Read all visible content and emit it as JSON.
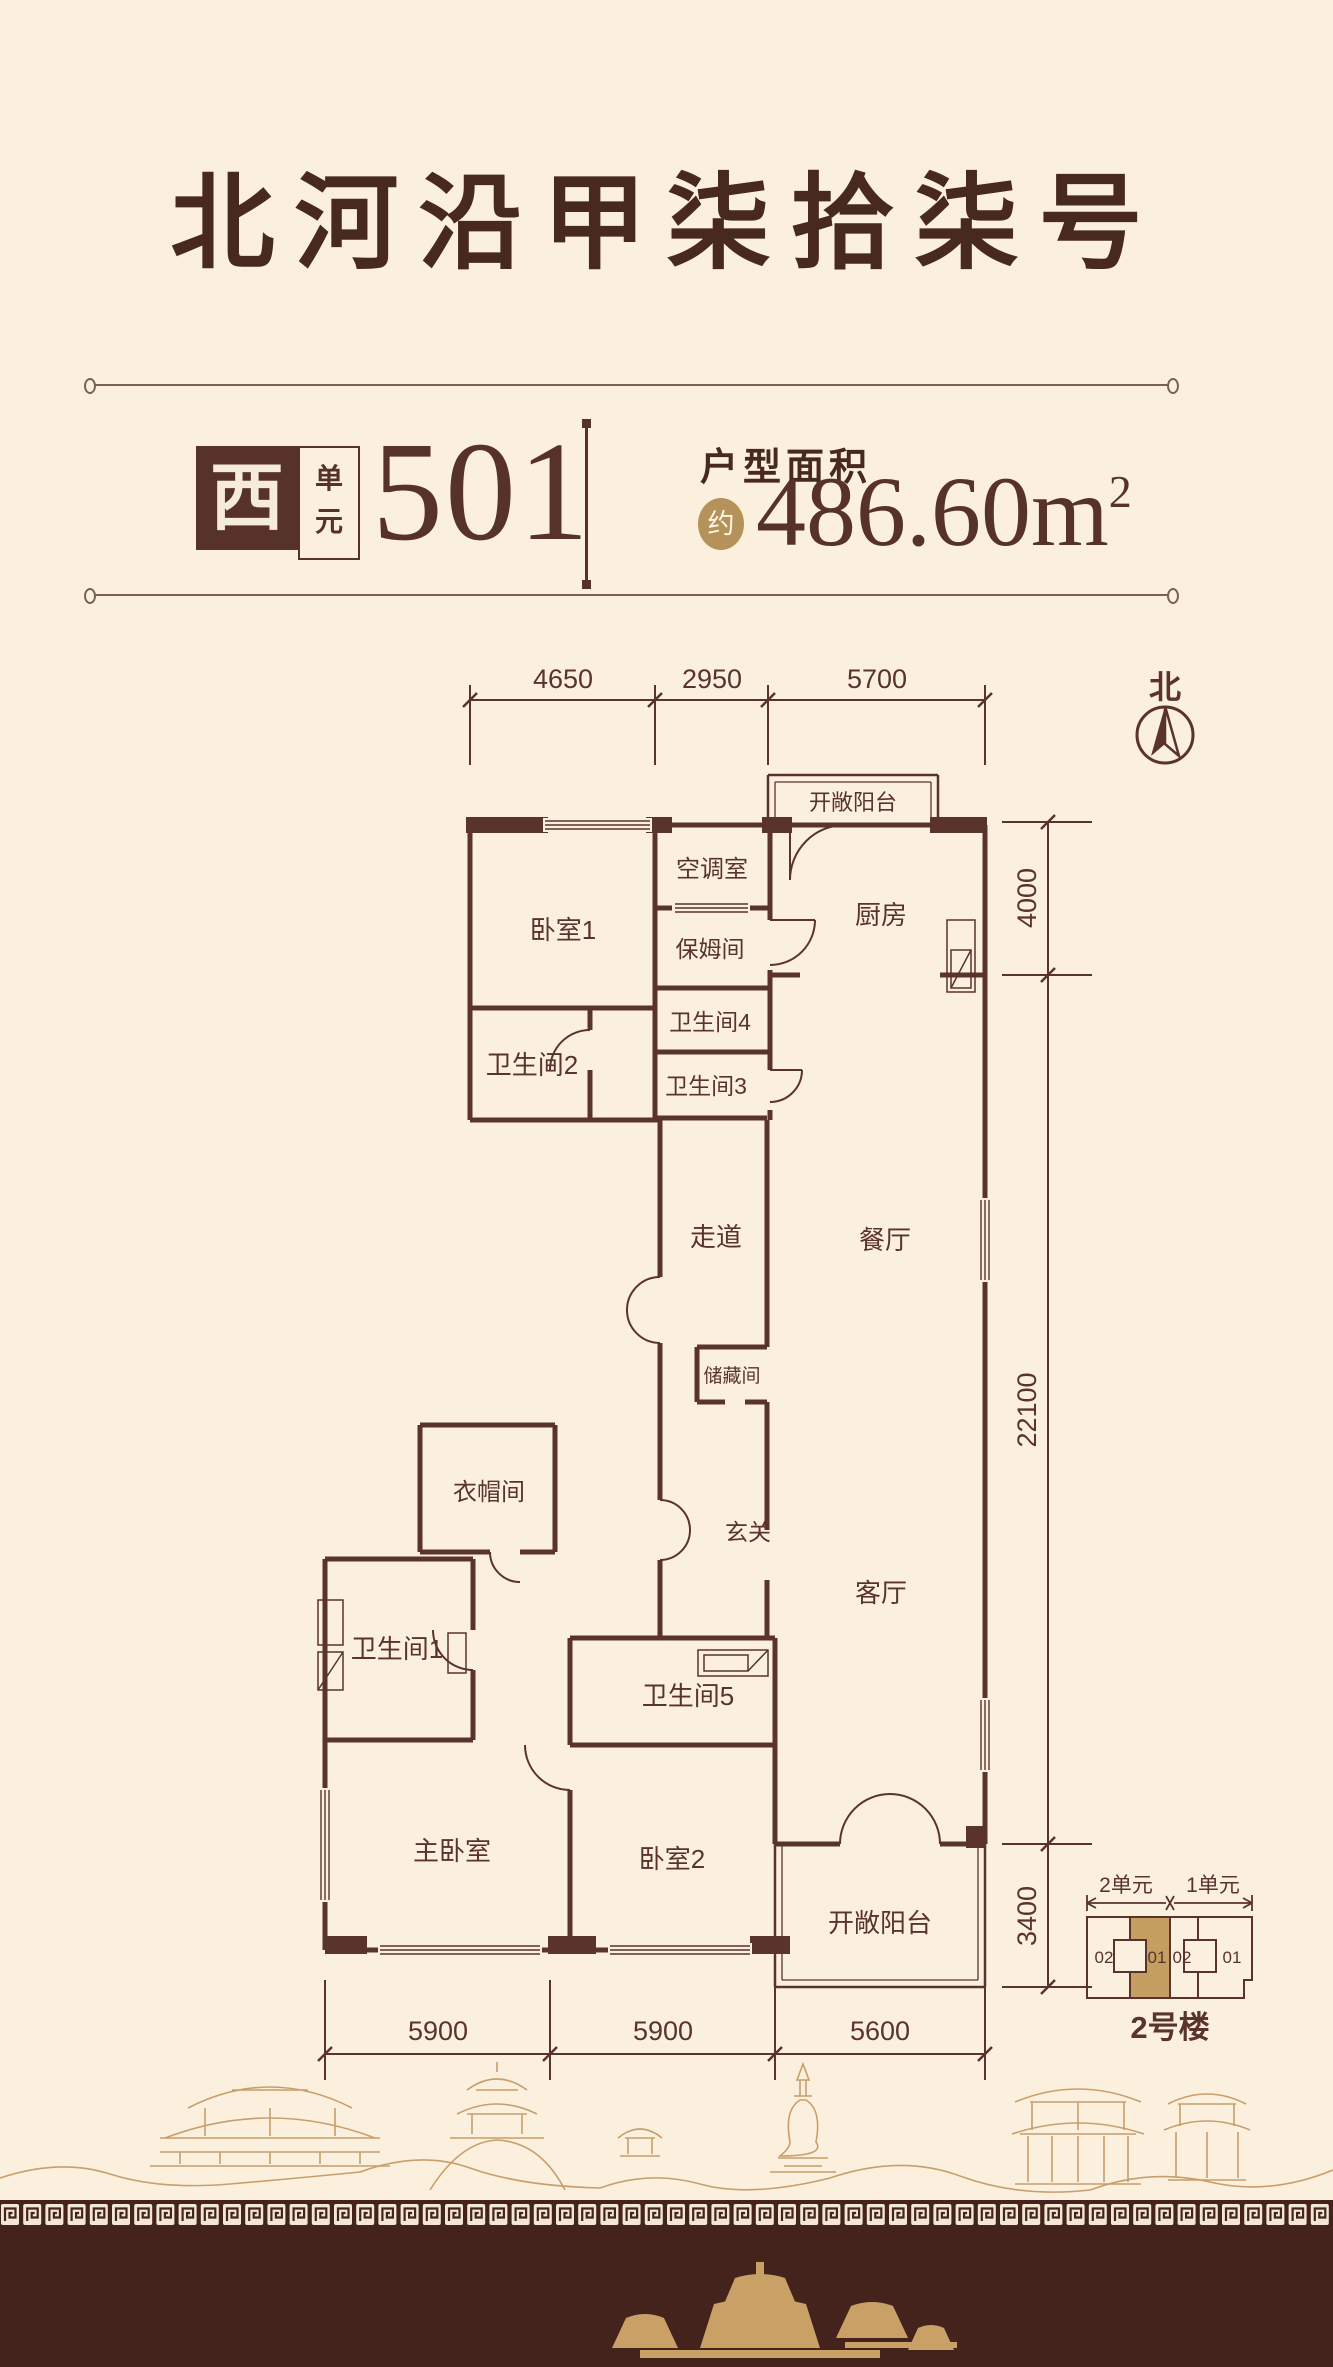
{
  "header": {
    "title": "北河沿甲柒拾柒号"
  },
  "unit": {
    "direction": "西",
    "suffix": [
      "单",
      "元"
    ],
    "number": "501"
  },
  "area": {
    "label": "户型面积",
    "approx": "约",
    "value": "486.60m",
    "sup": "2"
  },
  "north_label": "北",
  "dimensions": {
    "top": [
      "4650",
      "2950",
      "5700"
    ],
    "right": [
      "4000",
      "22100",
      "3400"
    ],
    "bottom": [
      "5900",
      "5900",
      "5600"
    ]
  },
  "rooms": {
    "balcony_top": "开敞阳台",
    "ac_room": "空调室",
    "kitchen": "厨房",
    "bedroom1": "卧室1",
    "nanny_room": "保姆间",
    "bath4": "卫生间4",
    "bath2": "卫生间2",
    "bath3": "卫生间3",
    "corridor": "走道",
    "dining": "餐厅",
    "storage": "储藏间",
    "foyer": "玄关",
    "cloakroom": "衣帽间",
    "bath1": "卫生间1",
    "living": "客厅",
    "bath5": "卫生间5",
    "master_bedroom": "主卧室",
    "bedroom2": "卧室2",
    "balcony_bottom": "开敞阳台"
  },
  "keyplan": {
    "unit_left": "2单元",
    "unit_right": "1单元",
    "cells": [
      "02",
      "01",
      "02",
      "01"
    ],
    "building": "2号楼"
  },
  "colors": {
    "background": "#fbf0de",
    "wall": "#5a332c",
    "title": "#48291d",
    "gold": "#b5925a",
    "keyplan_highlight": "#c59e61",
    "footer": "#45231d",
    "skyline": "#c89e6b"
  }
}
